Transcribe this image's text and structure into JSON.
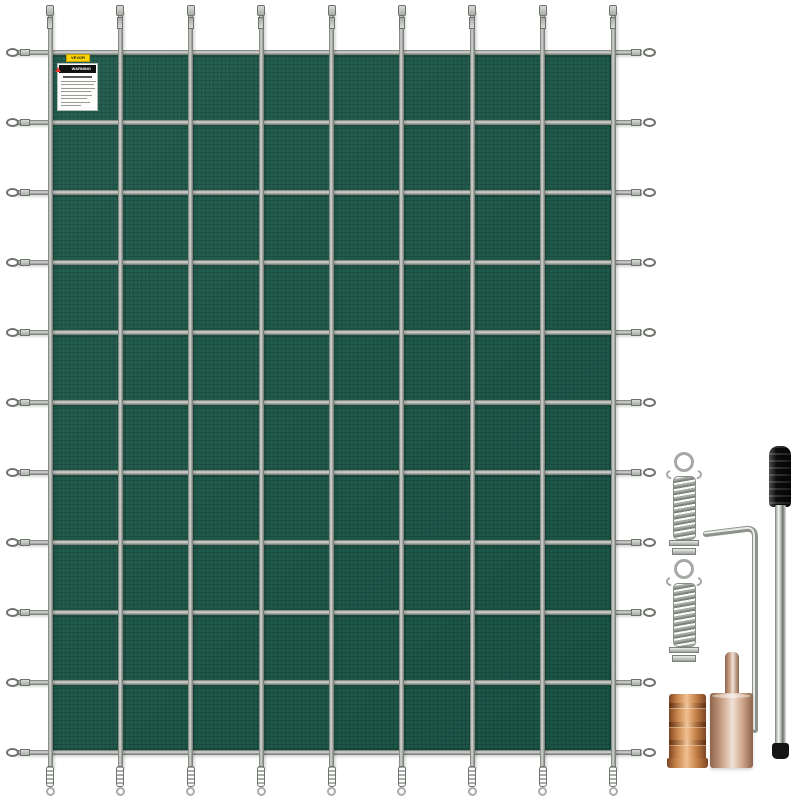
{
  "background_color": "#ffffff",
  "product": "green mesh pool safety cover with anchor installation kit",
  "cover": {
    "type": "rectangular-safety-cover",
    "mesh_color": "#1d5a4b",
    "mesh_grid_line_color": "rgba(3,32,22,0.22)",
    "binding_color": "#134437",
    "grid_columns": 8,
    "grid_rows": 10,
    "strap_light": "#d8dbd6",
    "strap_mid": "#a9ada8",
    "strap_dark": "#6e726d"
  },
  "warning_label": {
    "brand_tag": "VEVOR",
    "brand_tag_bg": "#ffd400",
    "header": "WARNING",
    "header_bg": "#111111",
    "triangle_color": "#e23b2e",
    "body_lines": 8
  },
  "accessories": {
    "hardware_gray": "#a6aaa5",
    "rod_handle_color": "#141414",
    "chrome_light": "#f4f5f3",
    "chrome_dark": "#7a7e79",
    "brass_light": "#f0c091",
    "brass_mid": "#c8834a",
    "brass_dark": "#7e4523",
    "tamper_light": "#f0e2d6",
    "tamper_mid": "#cfa78d",
    "tamper_dark": "#8d6349",
    "items": [
      {
        "id": "spring-1",
        "label": "stainless-steel-spring"
      },
      {
        "id": "spring-2",
        "label": "stainless-steel-spring"
      },
      {
        "id": "hex-key",
        "label": "hex-key-tool"
      },
      {
        "id": "installation-rod",
        "label": "installation-rod"
      },
      {
        "id": "brass-anchor",
        "label": "brass-anchor"
      },
      {
        "id": "tamping-tool",
        "label": "tamping-tool"
      }
    ]
  }
}
